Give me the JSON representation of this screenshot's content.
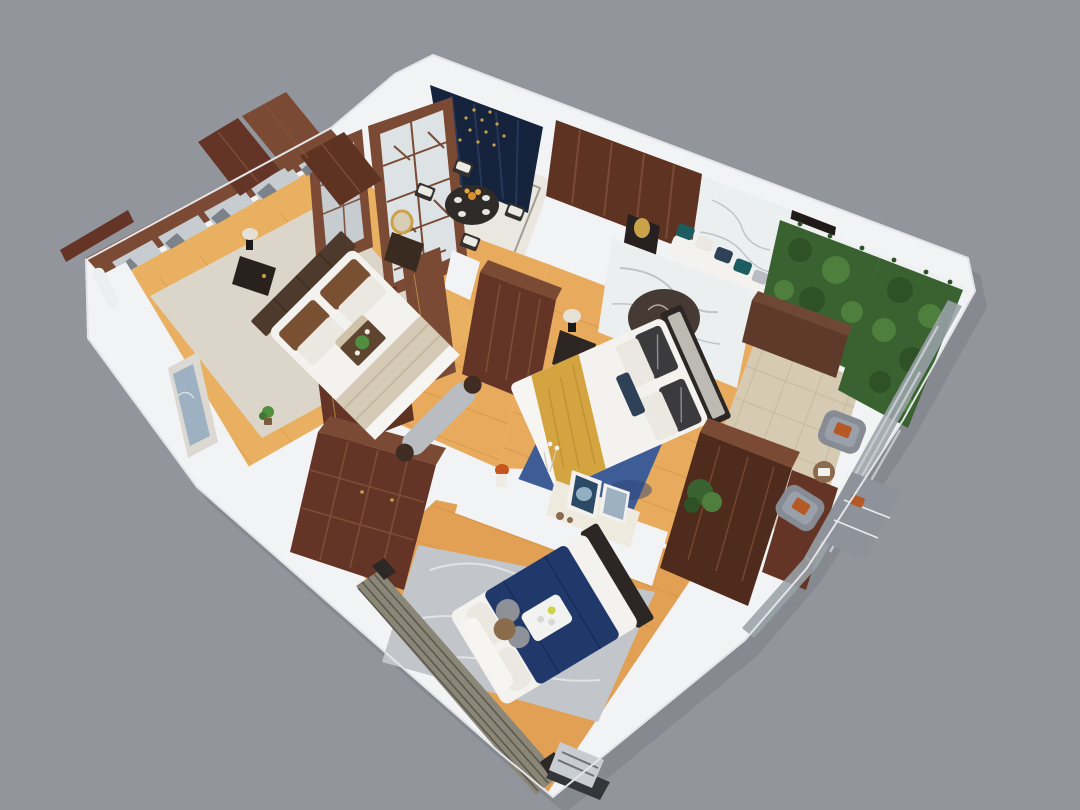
{
  "scene": {
    "type": "3d-apartment-cutaway-render",
    "style": "new-chinese-interior",
    "rooms": [
      {
        "name": "entry-dining",
        "furniture": [
          "round-dining-table",
          "four-chairs",
          "lattice-glass-doors",
          "navy-accent-wall"
        ]
      },
      {
        "name": "master-bedroom",
        "furniture": [
          "double-bed-yellow-throw",
          "marble-medallion-wall",
          "bench-sofa",
          "gold-table-lamps",
          "nightstand",
          "wardrobes",
          "blue-rug"
        ]
      },
      {
        "name": "second-bedroom",
        "furniture": [
          "double-bed-beige",
          "mirror-window-headboard-wall",
          "foot-bench",
          "nightstands",
          "wardrobe-row",
          "art-frame-wall"
        ]
      },
      {
        "name": "third-bedroom",
        "furniture": [
          "double-bed-navy",
          "large-wardrobe",
          "console-with-art-frames",
          "gray-marble-rug",
          "louver-window-wall",
          "ac-unit"
        ]
      },
      {
        "name": "balcony",
        "furniture": [
          "green-plant-walls",
          "two-rattan-lounge-chairs",
          "side-table",
          "glass-railing",
          "planter-cabinet",
          "bush"
        ]
      },
      {
        "name": "hallway",
        "furniture": [
          "standing-door-panels",
          "wardrobe"
        ]
      }
    ]
  },
  "palette": {
    "bg": "#93959c",
    "shadow": "#5e6067",
    "slab": "#f2f3f5",
    "slab_edge": "#d3d5da",
    "wood_floor": "#e8ab5e",
    "wood_floor_b2": "#eab062",
    "wood_floor_b3": "#e2a055",
    "plank_line": "#cf8f42",
    "tile_dining": "#e9e7e0",
    "tile_inlay": "#a39e92",
    "tile_balcony": "#d6cbb2",
    "tile_line": "#c2b69b",
    "navy_wall": "#16233c",
    "navy_streak": "#2a3c5e",
    "gold": "#c9a24a",
    "wood_dark": "#4f2b1e",
    "wood_mid": "#643526",
    "wood_panel": "#5f3322",
    "wood_light": "#7a4a34",
    "wood_line": "#86543c",
    "marble": "#eceff0",
    "marble_vein": "#b4b8bc",
    "medallion": "#463b34",
    "medallion_art": "#cfc8bf",
    "bed_white": "#f4f2ee",
    "sheet_white": "#f7f5f1",
    "headboard_dark": "#2c2725",
    "headboard_panel": "#bdb9b3",
    "pillow_white": "#ebe8e2",
    "pillow_dark": "#3b3b3e",
    "pillow_brown": "#7a5033",
    "pillow_teal": "#1d5c60",
    "pillow_navy": "#2e4156",
    "blanket_yellow": "#d4a440",
    "blanket_yellow_fold": "#bd8f33",
    "blanket_beige": "#d5cab6",
    "duvet_navy": "#21386b",
    "headboard_b2": "#4e3a2c",
    "rug_blue": "#3e5d97",
    "rug_blue_dark": "#2c4577",
    "rug_orange_fleck": "#bf7a3c",
    "rug_gray": "#c2c5ca",
    "rug_gray_vein": "#e8eaed",
    "rug_beige": "#dbd6c9",
    "bench_gray": "#b9bdc2",
    "bench_end": "#3f2d23",
    "green_dark": "#2e5226",
    "green_mid": "#3a6130",
    "green_light": "#4e7f3d",
    "chair_gray": "#868b94",
    "chair_cushion": "#99a0aa",
    "orange_cushion": "#b55a26",
    "glass": "#9aa2a8",
    "glass_streak": "#c8cdd1",
    "pane_gray": "#c7ccd1",
    "mountain_gray": "#6f767d",
    "art_blue": "#9db1c2",
    "art_navy": "#2b4a66",
    "console_white": "#efeade",
    "table_black": "#2e2b29",
    "chair_frame": "#35302d",
    "lamp_black": "#1c1a19",
    "lamp_white": "#e6e1d6",
    "louver": "#8b8778",
    "louver_line": "#57544a",
    "ac_gray": "#c9cdd1",
    "ac_dark": "#35363a",
    "plant_green": "#4f8f3f",
    "pot_brown": "#7a5a40",
    "coral_orange": "#c4561e",
    "planter_brown": "#5d3a2a",
    "planter_top": "#6f4835",
    "wicker_table": "#8a6b4f"
  }
}
